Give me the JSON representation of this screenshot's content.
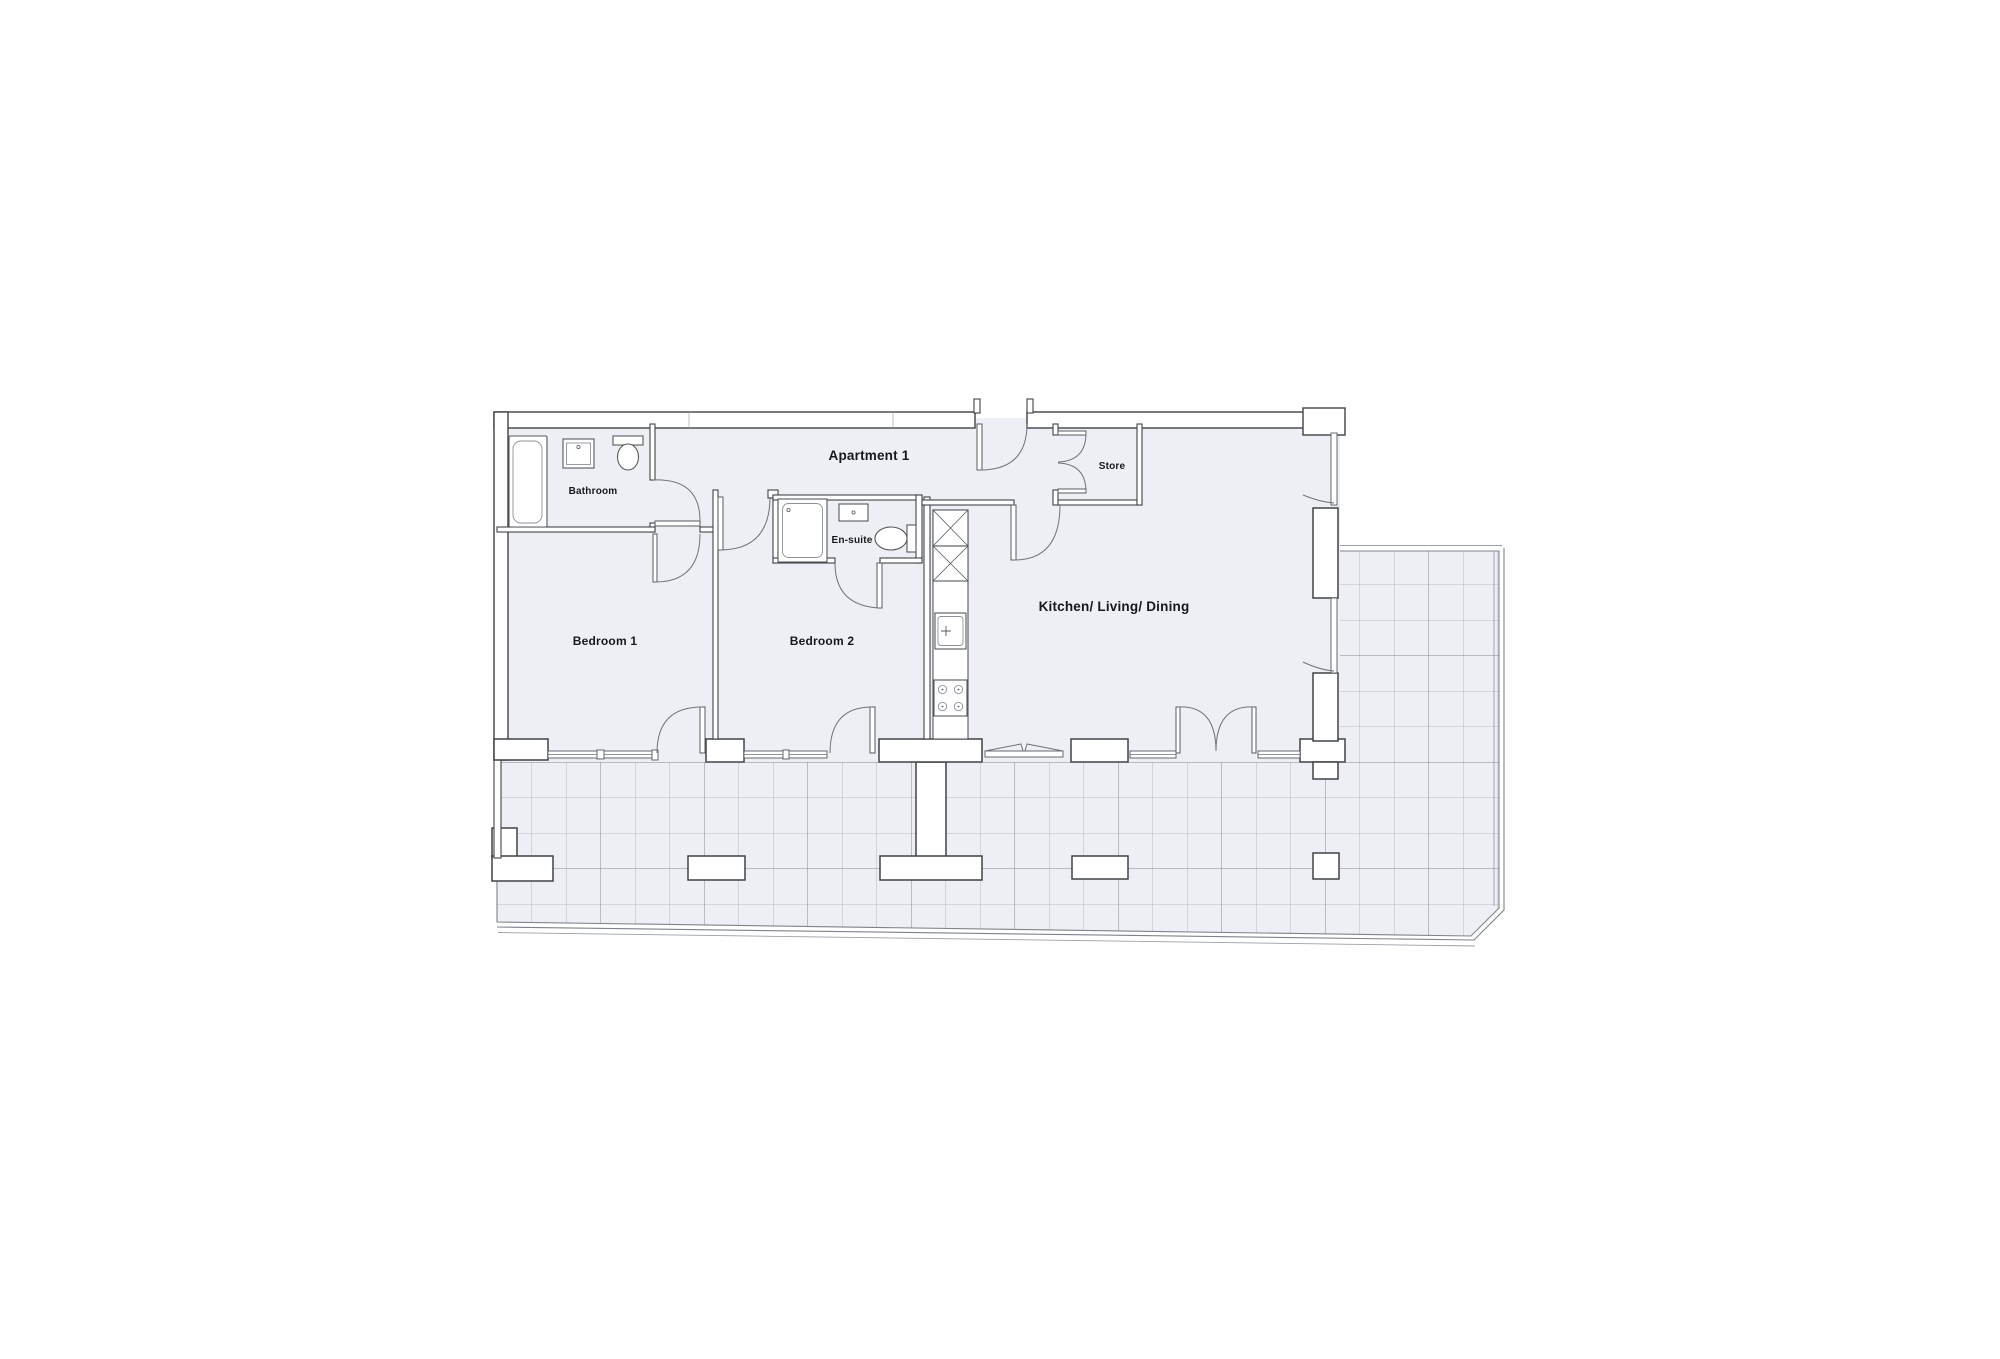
{
  "floorplan": {
    "title": "Apartment 1",
    "rooms": {
      "hall": {
        "label": "Apartment 1"
      },
      "bathroom": {
        "label": "Bathroom"
      },
      "ensuite": {
        "label": "En-suite"
      },
      "bedroom1": {
        "label": "Bedroom 1"
      },
      "bedroom2": {
        "label": "Bedroom 2"
      },
      "kitchen": {
        "label": "Kitchen/ Living/ Dining"
      },
      "store": {
        "label": "Store"
      }
    },
    "fixtures": {
      "bathroom": [
        "bathtub",
        "washbasin",
        "toilet"
      ],
      "ensuite": [
        "shower",
        "washbasin",
        "toilet"
      ],
      "kitchen": [
        "tall-units",
        "sink",
        "hob"
      ]
    },
    "areas": [
      "terrace"
    ],
    "colors": {
      "background": "#ffffff",
      "wall_line": "#3f4347",
      "interior_fill": "#edeff4",
      "tile_line": "#a6acb5",
      "tile_line_major": "#81878f",
      "door_arc": "#6e7379",
      "label_text": "#17181a"
    }
  }
}
